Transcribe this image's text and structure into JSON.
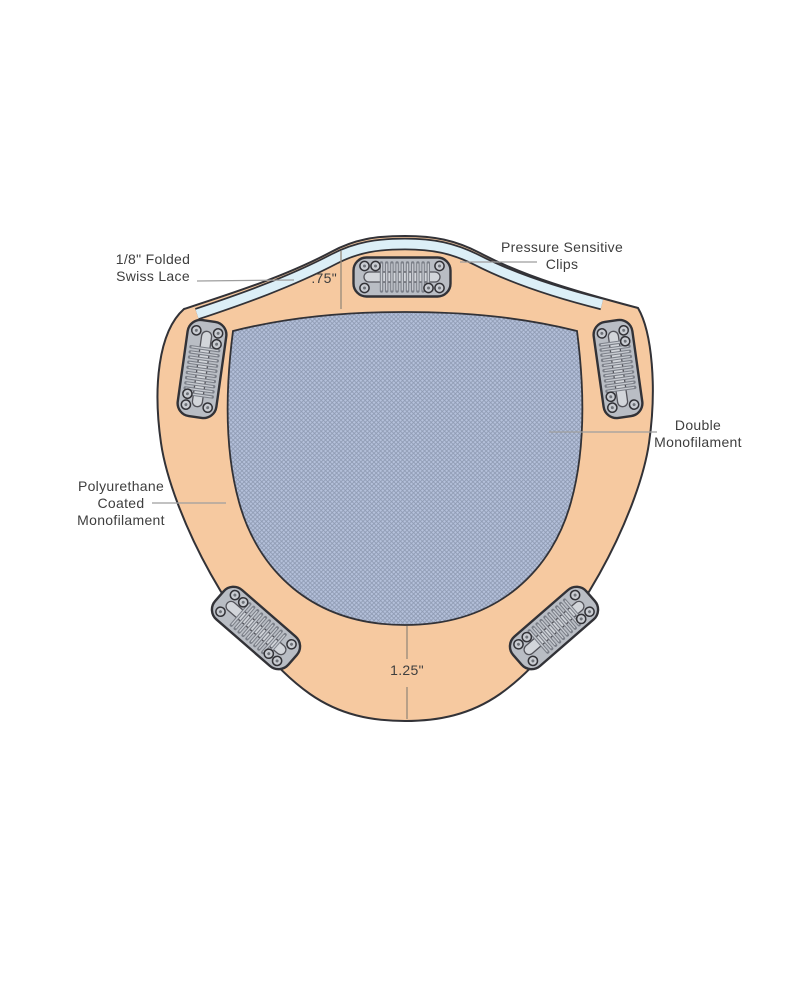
{
  "diagram": {
    "type": "product-construction-diagram",
    "subject": "hair topper cap construction",
    "labels": {
      "swiss_lace": {
        "line1": "1/8\" Folded",
        "line2": "Swiss Lace"
      },
      "pressure_clips": {
        "line1": "Pressure Sensitive",
        "line2": "Clips"
      },
      "double_monofilament": {
        "line1": "Double",
        "line2": "Monofilament"
      },
      "polyurethane": {
        "line1": "Polyurethane",
        "line2": "Coated",
        "line3": "Monofilament"
      },
      "front_measurement": ".75\"",
      "back_measurement": "1.25\""
    },
    "colors": {
      "cap_base": "#F6C9A0",
      "swiss_lace_band": "#DCEFF7",
      "monofilament_mesh": "#B5C1DB",
      "mesh_hatch": "#8E9AB2",
      "clip_metal": "#B9BDC4",
      "outline": "#323237",
      "leader_line": "#9E9E9E",
      "label_text": "#3E3E3E"
    }
  }
}
